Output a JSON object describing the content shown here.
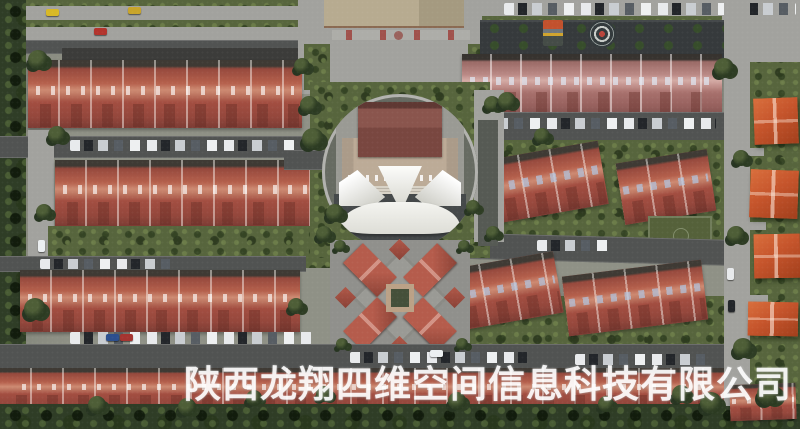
{
  "watermark": {
    "text": "陕西龙翔四维空间信息科技有限公司"
  },
  "scene": {
    "type": "aerial-satellite-photo",
    "description": "Overhead aerial view of a residential compound: parallel rows of red tile-roofed townhouses, a circular central plaza with a clubhouse and white tensile canopies, an ornate cross-shaped pavilion, parking lots lined with cars, a dark rooftop with a circular emblem, orange-roofed villas along the right edge, and dense green trees bordering the site."
  },
  "palette": {
    "roof_red": "#a85446",
    "roof_pink": "#b8827e",
    "roof_orange": "#c6552c",
    "road_dark": "#515352",
    "pavement_light": "#a2a29e",
    "grass_dark": "#57653d",
    "tree_dark": "#2f3d26",
    "tent_white": "#f0f0ec",
    "watermark_white": "#ffffff"
  }
}
